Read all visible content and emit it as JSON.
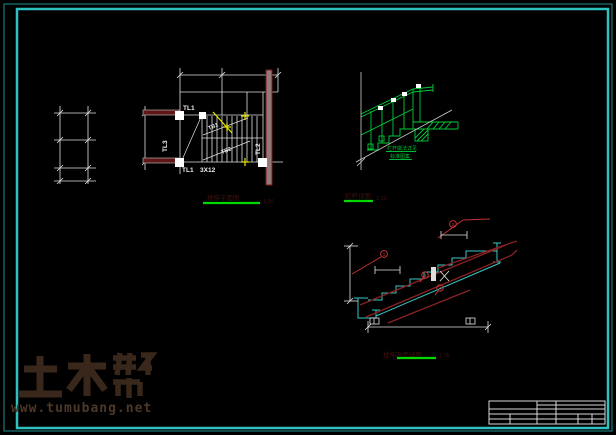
{
  "watermark": {
    "brand": "土木帮",
    "url": "www.tumubang.net"
  },
  "plan": {
    "title": "楼梯平面图",
    "scale": "1:50",
    "labels": {
      "tl1_top": "TL1",
      "tl1_bottom": "TL1",
      "beam_spec": "3X12",
      "tl3_left": "TL3",
      "tl2_right": "TL2",
      "flight_up": "TB1",
      "flight_down": "TB2"
    }
  },
  "railing": {
    "title": "栏杆详图",
    "scale": "1:20",
    "note_line1": "栏杆做法详见",
    "note_line2": "标准图集"
  },
  "section": {
    "title": "楼梯剖面详图",
    "scale": "1:25",
    "callouts": [
      "1",
      "2",
      "3",
      "4"
    ]
  },
  "colors": {
    "frame_outer": "#1d9090",
    "frame_inner": "#2fc0c0",
    "cad_white": "#e2e2e2",
    "beam_dark_red": "#5e1818",
    "rebar_red": "#8a2222",
    "leader_red": "#c03232",
    "section_cut_yellow": "#e8e800",
    "railing_green": "#00cc3a",
    "underline_green": "#00d800",
    "stair_cyan": "#38c8c8",
    "watermark_brown": "#3b2a1c"
  }
}
